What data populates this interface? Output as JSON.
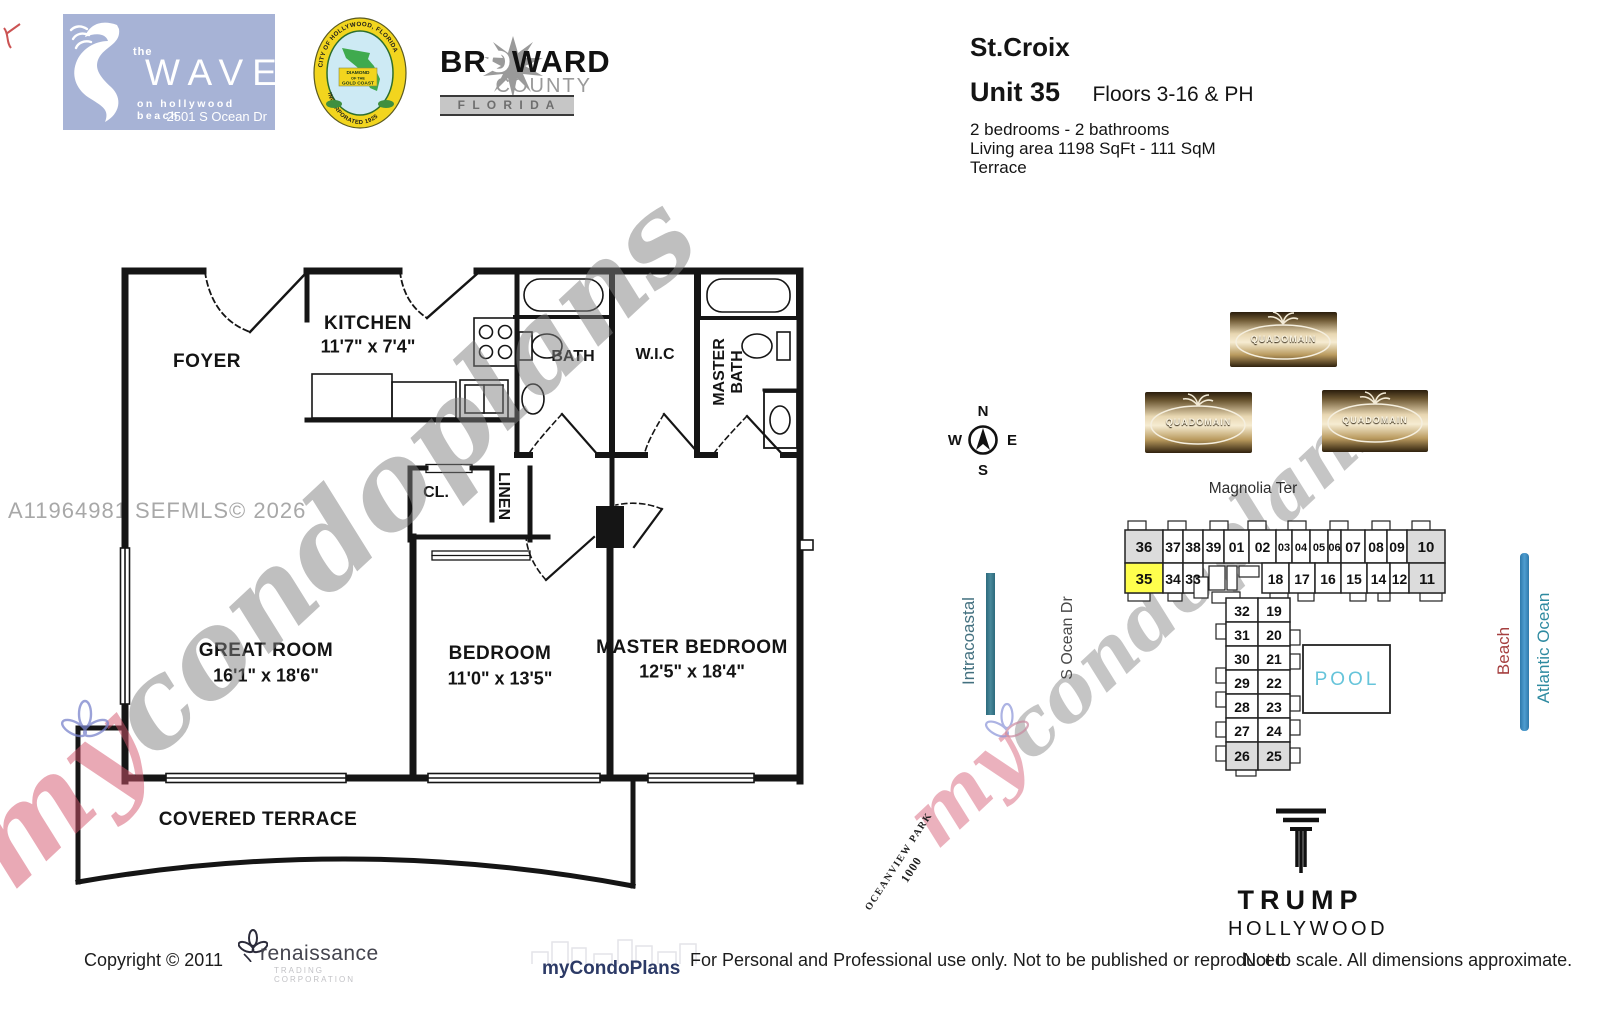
{
  "header": {
    "wave": {
      "the": "the",
      "name": "WAVE",
      "tagline": "on hollywood beach",
      "address": "2501 S Ocean Dr"
    },
    "seal": {
      "arc_top": "CITY OF HOLLYWOOD, FLORIDA",
      "arc_bottom": "INCORPORATED 1925",
      "ribbon1": "DIAMOND",
      "ribbon2": "OF THE",
      "ribbon3": "GOLD COAST"
    },
    "broward": {
      "pre": "BR",
      "o": "O",
      "post": "WARD",
      "county_word": "COUNTY",
      "state": "F L O R I D A"
    },
    "building_name": "St.Croix",
    "unit": "Unit 35",
    "floors": "Floors 3-16 & PH",
    "beds_baths": "2 bedrooms - 2 bathrooms",
    "living_area": "Living area 1198 SqFt - 111 SqM",
    "feature": "Terrace"
  },
  "floorplan": {
    "mls_id": "A11964981  SEFMLS© 2026",
    "watermark": {
      "pre": "my",
      "suffix": "condoplans"
    },
    "rooms": {
      "foyer": "FOYER",
      "kitchen": "KITCHEN",
      "kitchen_dim": "11'7\" x 7'4\"",
      "bath": "BATH",
      "wic": "W.I.C",
      "master_bath_line1": "MASTER",
      "master_bath_line2": "BATH",
      "closet": "CL.",
      "linen": "LINEN",
      "great_room": "GREAT ROOM",
      "great_room_dim": "16'1\" x 18'6\"",
      "bedroom": "BEDROOM",
      "bedroom_dim": "11'0\" x 13'5\"",
      "master_bedroom": "MASTER BEDROOM",
      "master_bedroom_dim": "12'5\" x 18'4\"",
      "covered_terrace": "COVERED TERRACE"
    }
  },
  "sitemap": {
    "street": "Magnolia Ter",
    "compass": {
      "n": "N",
      "e": "E",
      "s": "S",
      "w": "W"
    },
    "quadomain": "QUADOMAIN",
    "pool": "POOL",
    "highlighted_unit": "35",
    "top_row": [
      "36",
      "37",
      "38",
      "39",
      "01",
      "02",
      "03",
      "04",
      "05",
      "06",
      "07",
      "08",
      "09",
      "10"
    ],
    "second_row": [
      "35",
      "34",
      "33",
      "18",
      "17",
      "16",
      "15",
      "14",
      "12",
      "11"
    ],
    "west_column": [
      "32",
      "31",
      "30",
      "29",
      "28",
      "27",
      "26"
    ],
    "east_column": [
      "19",
      "20",
      "21",
      "22",
      "23",
      "24",
      "25"
    ],
    "labels": {
      "intracoastal": "Intracoastal",
      "s_ocean_dr": "S Ocean Dr",
      "beach": "Beach",
      "atlantic_ocean": "Atlantic Ocean",
      "park_name": "OCEANVIEW PARK",
      "park_number": "1000"
    },
    "colors": {
      "highlight": "#ffff4d",
      "shaded": "#dcdcdc",
      "pool_text": "#66c4da",
      "intracoastal_bar": "#3a7d8f",
      "ocean_bar": "#4090c2",
      "beach_text": "#a53f3f",
      "atlantic_text": "#2e8aa0"
    }
  },
  "trump": {
    "line1": "TRUMP",
    "line2": "HOLLYWOOD"
  },
  "footer": {
    "copyright": "Copyright © 2011",
    "renaissance_name": "renaissance",
    "renaissance_sub": "TRADING CORPORATION",
    "mycondoplans": "myCondoPlans",
    "disclaimer_left": "For Personal and Professional use only.  Not to be published or reproduced.",
    "disclaimer_right": "Not to scale.  All dimensions approximate."
  }
}
